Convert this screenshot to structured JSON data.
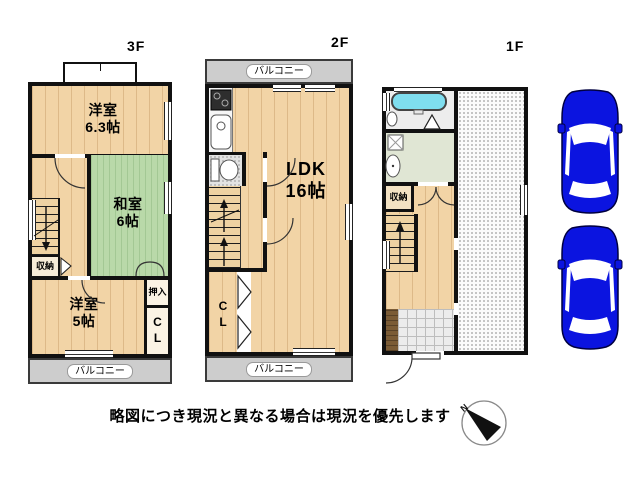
{
  "floors": {
    "f3": {
      "title": "3F",
      "rooms": {
        "west1": {
          "name": "洋室",
          "size": "6.3帖"
        },
        "washitsu": {
          "name": "和室",
          "size": "6帖"
        },
        "storage": {
          "label": "収納"
        },
        "west2": {
          "name": "洋室",
          "size": "5帖"
        },
        "oshiire": {
          "label": "押入"
        },
        "closet": {
          "label": "CL"
        },
        "balcony": {
          "label": "バルコニー"
        }
      }
    },
    "f2": {
      "title": "2F",
      "rooms": {
        "balcony_top": {
          "label": "バルコニー"
        },
        "ldk": {
          "name": "LDK",
          "size": "16帖"
        },
        "closet": {
          "label": "CL"
        },
        "balcony_bottom": {
          "label": "バルコニー"
        }
      }
    },
    "f1": {
      "title": "1F",
      "rooms": {
        "storage": {
          "label": "収納"
        }
      }
    }
  },
  "footer": {
    "disclaimer": "略図につき現況と異なる場合は現況を優先します"
  },
  "compass": {
    "north_label": "N"
  },
  "colors": {
    "wall": "#111111",
    "wood_floor": "#f2d4a6",
    "tatami": "#b9d9a9",
    "balcony": "#cdcdcd",
    "bathtub": "#7fdeef",
    "washroom_floor": "#e0e6d4",
    "genkan_step": "#7b5c36",
    "car": "#0b14e0"
  }
}
